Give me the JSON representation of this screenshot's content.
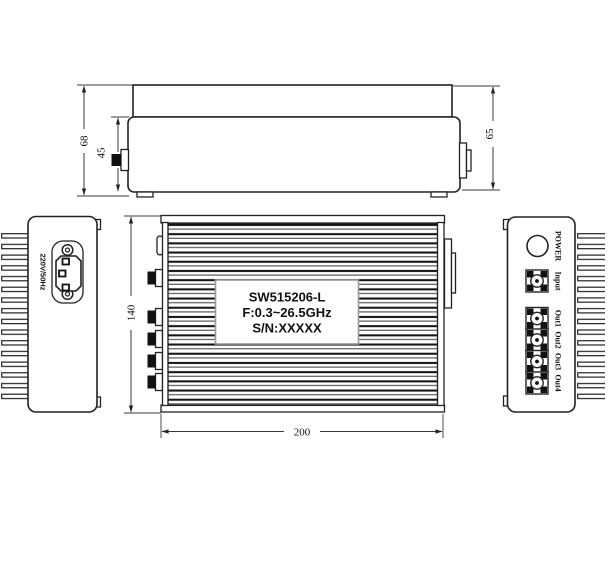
{
  "drawing": {
    "top_view": {
      "dim_total_height": "68",
      "dim_body_height": "45",
      "dim_depth": "65"
    },
    "front_view": {
      "dim_height": "140",
      "dim_width": "200",
      "nameplate": {
        "line1": "SW515206-L",
        "line2": "F:0.3~26.5GHz",
        "line3": "S/N:XXXXX"
      }
    },
    "left_view": {
      "power_spec": "220V/50Hz"
    },
    "right_view": {
      "power_label": "POWER",
      "input_label": "Input",
      "outputs": [
        "Out1",
        "Out2",
        "Out3",
        "Out4"
      ]
    }
  }
}
